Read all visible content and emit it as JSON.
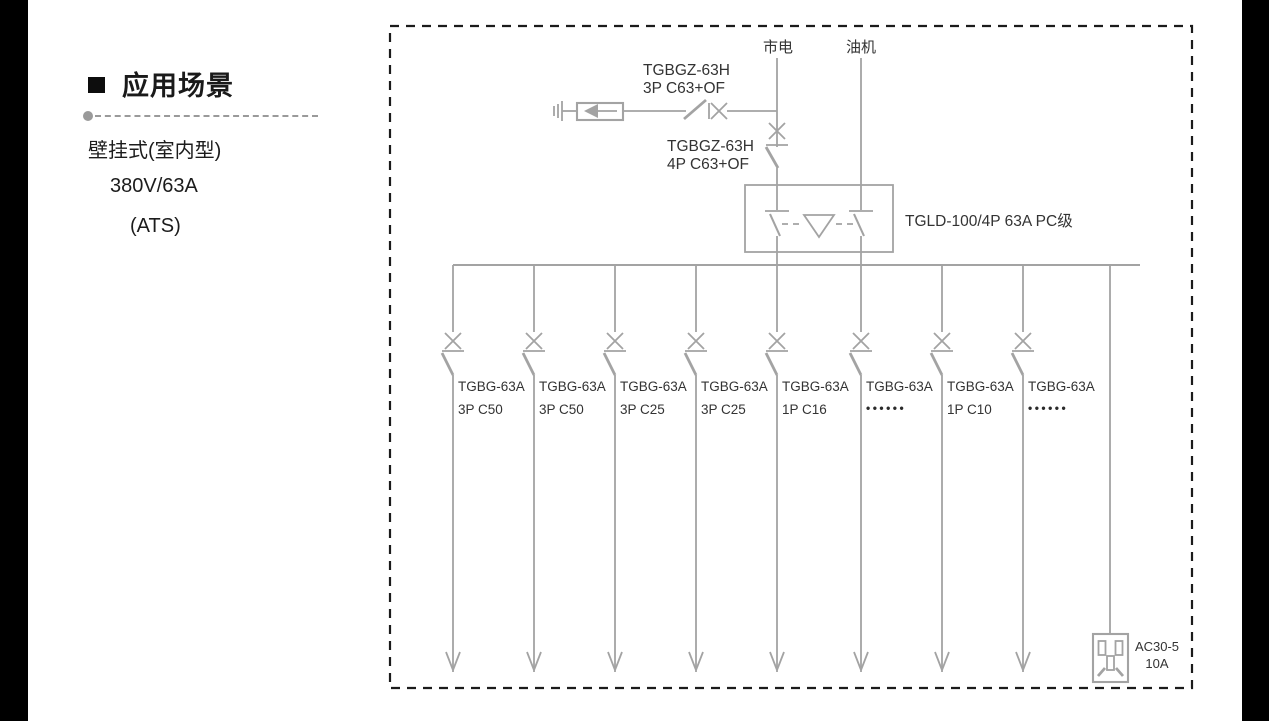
{
  "sidebar": {
    "heading": "应用场景",
    "items": [
      "壁挂式(室内型)",
      "380V/63A",
      "(ATS)"
    ]
  },
  "diagram": {
    "source_mains": "市电",
    "source_generator": "油机",
    "spd_breaker_model": "TGBGZ-63H",
    "spd_breaker_spec": "3P C63+OF",
    "main_breaker_model": "TGBGZ-63H",
    "main_breaker_spec": "4P C63+OF",
    "ats_label": "TGLD-100/4P 63A PC级",
    "branches": [
      {
        "model": "TGBG-63A",
        "spec": "3P C50"
      },
      {
        "model": "TGBG-63A",
        "spec": "3P C50"
      },
      {
        "model": "TGBG-63A",
        "spec": "3P C25"
      },
      {
        "model": "TGBG-63A",
        "spec": "3P C25"
      },
      {
        "model": "TGBG-63A",
        "spec": "1P C16"
      },
      {
        "model": "TGBG-63A",
        "spec": "••••••"
      },
      {
        "model": "TGBG-63A",
        "spec": "1P C10"
      },
      {
        "model": "TGBG-63A",
        "spec": "••••••"
      }
    ],
    "socket_model": "AC30-5",
    "socket_rating": "10A",
    "colors": {
      "line": "#a3a3a3",
      "border": "#1b1b1b",
      "text": "#333333",
      "edge_bar": "#000000"
    }
  }
}
